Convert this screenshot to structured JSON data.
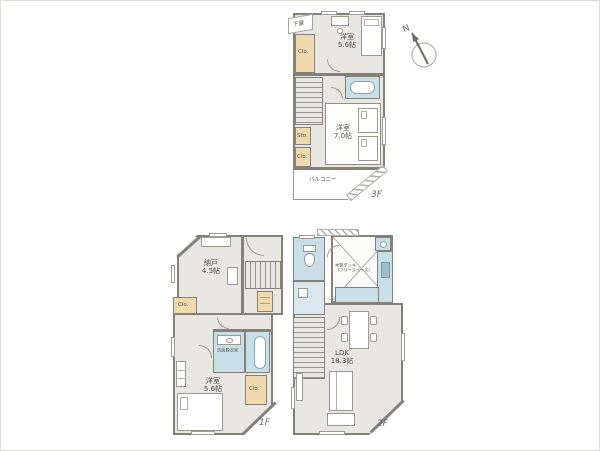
{
  "document": {
    "kind": "madori-floor-plan",
    "floors_shown": 3
  },
  "colors": {
    "wall": "#84817b",
    "floor": "#e9e7e2",
    "closet": "#efd9ad",
    "water": "#c9dfe7",
    "outline": "#9b9892",
    "text": "#55524c",
    "background": "#ffffff"
  },
  "floor3": {
    "tag": "3F",
    "geya": "下屋",
    "closet_top": "Clo.",
    "bedroom_top_name": "洋室",
    "bedroom_top_size": "5.6帖",
    "storage": "Sto.",
    "closet_mid": "Clo.",
    "bedroom_btm_name": "洋室",
    "bedroom_btm_size": "7.0帖",
    "balcony": "バルコニー"
  },
  "floor1": {
    "tag": "1F",
    "storeroom_name": "納戸",
    "storeroom_size": "4.5帖",
    "closet_left": "Clo.",
    "washroom": "洗面脱衣室",
    "closet_btm": "Clo.",
    "bedroom_name": "洋室",
    "bedroom_size": "5.6帖"
  },
  "floor2": {
    "tag": "2F",
    "deck_note1": "木製デッキ",
    "deck_note2": "（フリースペース）",
    "ldk_name": "LDK",
    "ldk_size": "18.3帖"
  },
  "compass": {
    "north": "N"
  }
}
